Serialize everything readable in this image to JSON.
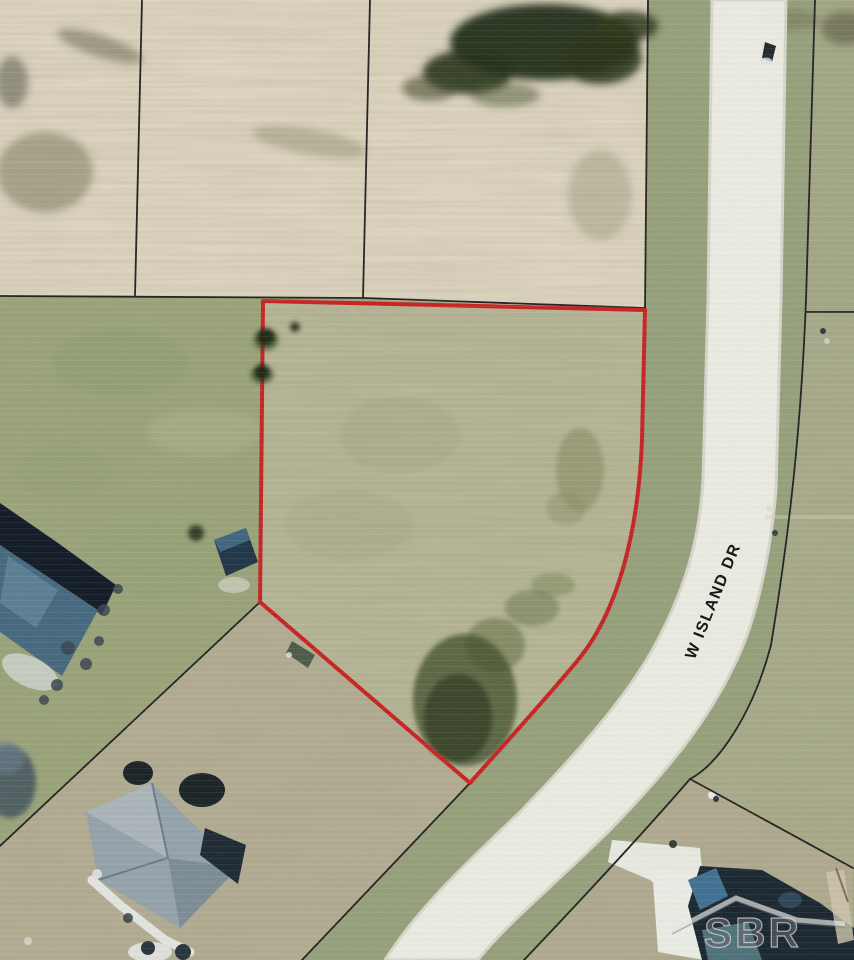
{
  "map": {
    "title": "Aerial parcel map",
    "street_label": "W ISLAND DR",
    "watermark_text": "SBR",
    "subject_lot": {
      "outline_color": "#c92020",
      "shape": "irregular lot with curved east side following road"
    },
    "road": {
      "name": "W Island Dr",
      "surface_color": "#f0efe8"
    },
    "colors": {
      "boundary_red": "#c92020",
      "parcel_line_black": "#1f1f1f",
      "farm_field_tan": "#d9cdb7",
      "grass_green": "#9ba479",
      "lot_grass": "#b2b190",
      "south_grass": "#b4ad93",
      "roof_slate_blue": "#44677f",
      "roof_gray": "#95a2aa",
      "roof_navy": "#17242f"
    },
    "features": [
      "plowed farm field across the north",
      "vacant subject lot outlined in red",
      "W Island Dr curving along the east side of the lot",
      "houses at northwest, southwest and southeast corners",
      "tree cover at top of field",
      "dark vegetation patch near south point of lot",
      "SBR watermark over southeast house"
    ]
  }
}
